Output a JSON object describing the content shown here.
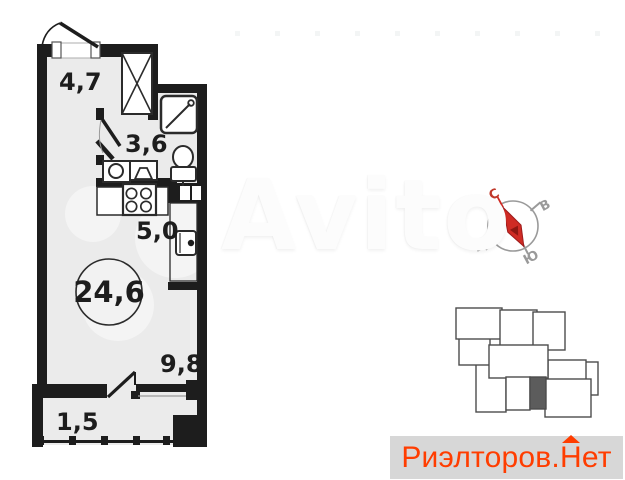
{
  "floor_plan": {
    "total_area": {
      "value": "24,6"
    },
    "rooms": [
      {
        "name": "hallway",
        "area": "4,7"
      },
      {
        "name": "bathroom",
        "area": "3,6"
      },
      {
        "name": "kitchen",
        "area": "5,0"
      },
      {
        "name": "room",
        "area": "9,8"
      },
      {
        "name": "balcony",
        "area": "1,5"
      }
    ]
  },
  "compass": {
    "north": "С",
    "east": "В",
    "south": "Ю",
    "west": "З"
  },
  "watermark": {
    "text": "Avito"
  },
  "logo": {
    "prefix": "Риэлторов.",
    "roof_letter": "Н",
    "suffix": "ет"
  },
  "colors": {
    "wall": "#1d1d1d",
    "floor": "#ebebeb",
    "fixture": "#2b2b2b",
    "map_outline": "#4c4c4c",
    "map_highlight": "#5c5c5c",
    "needle": "#cf2b24",
    "needle_dark": "#8e1712",
    "north_label": "#c0392b",
    "compass_gray": "#9a9a9a",
    "logo_text": "#ff3d00",
    "logo_background": "#d7d7d7"
  }
}
